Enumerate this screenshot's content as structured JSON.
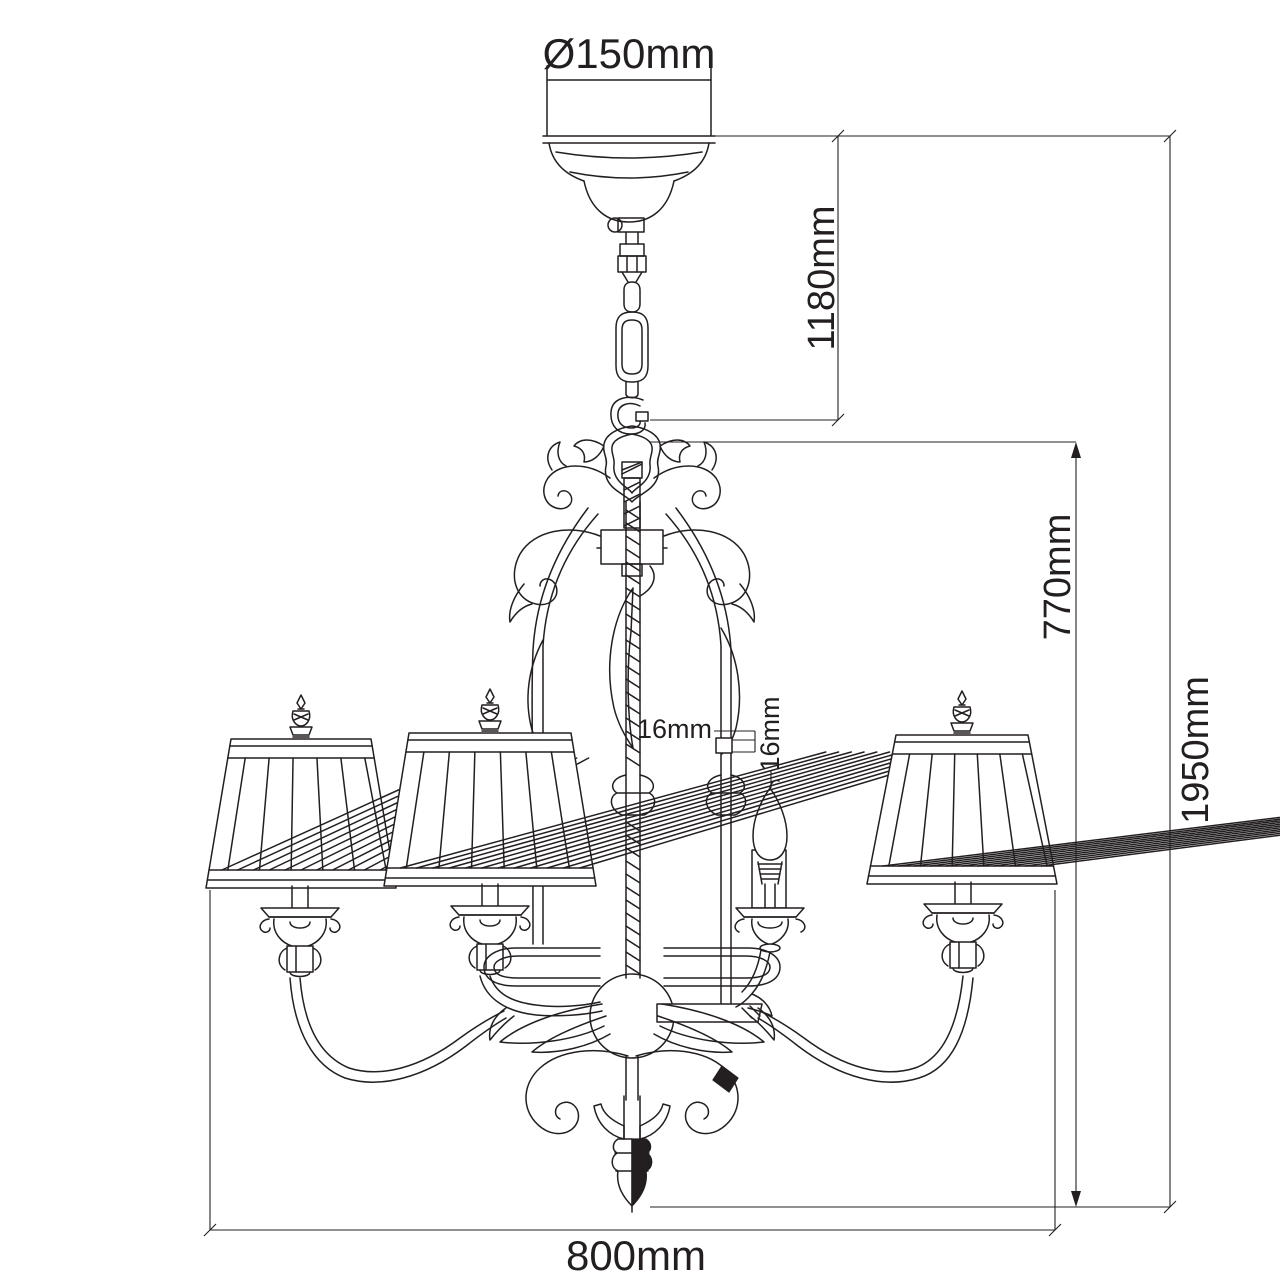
{
  "page": {
    "background_color": "#ffffff",
    "line_color": "#231f20"
  },
  "drawing": {
    "subject": "Black-and-white technical dimension drawing of a chandelier with ceiling canopy, suspension chain, scrolled cage frame, pleated lamp shades, bare candle bulb and bottom finial",
    "dimensions": {
      "canopy_diameter_label": "Ø150mm",
      "chain_suspension_label": "1180mm",
      "body_height_label": "770mm",
      "overall_height_label": "1950mm",
      "width_label": "800mm",
      "stem_tube_label": "16mm",
      "candle_socket_label": "16mm"
    }
  }
}
